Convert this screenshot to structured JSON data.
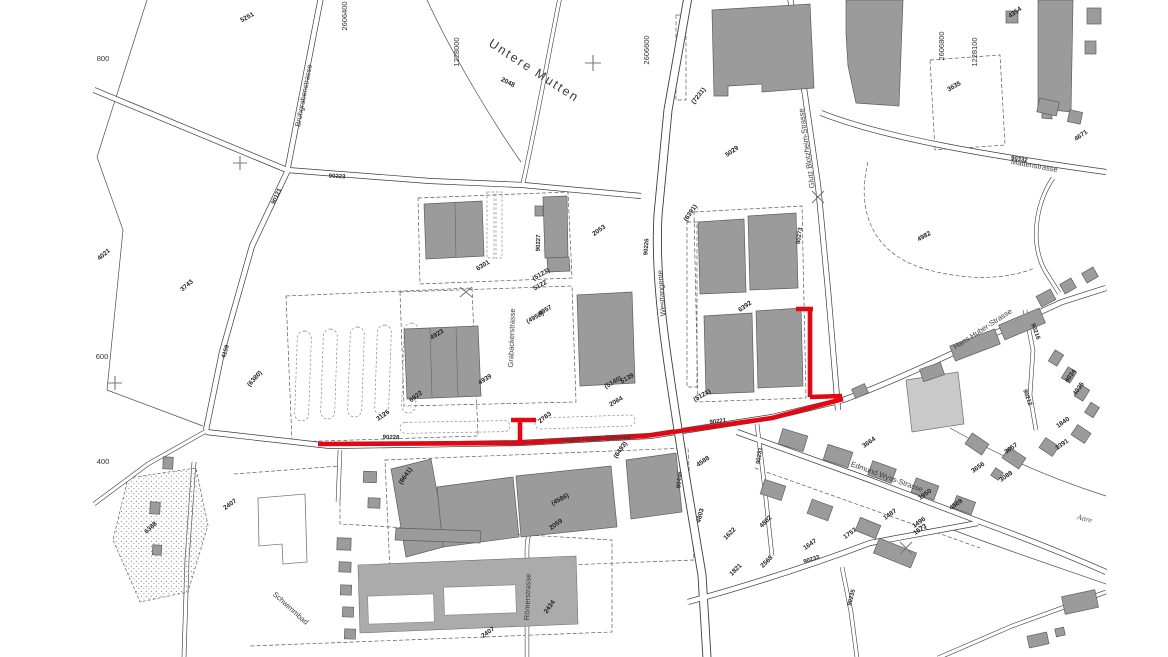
{
  "map": {
    "colors": {
      "route_highlight": "#e30613",
      "building_fill": "#9b9b9b",
      "building_light": "#c9c9c9",
      "line": "#3d3d3d"
    },
    "area_labels": [
      {
        "text": "Untere Mutten",
        "x": 532,
        "y": 74,
        "rot": 33
      }
    ],
    "street_labels": [
      {
        "text": "Brühgrabenstrasse",
        "x": 306,
        "y": 96,
        "rot": -79
      },
      {
        "text": "Glutz Blotzheim-Strasse",
        "x": 809,
        "y": 148,
        "rot": -98
      },
      {
        "text": "Grabackerstrasse",
        "x": 514,
        "y": 338,
        "rot": -88
      },
      {
        "text": "Westtangente",
        "x": 664,
        "y": 293,
        "rot": -94
      },
      {
        "text": "Mattenstrasse",
        "x": 1034,
        "y": 168,
        "rot": 10
      },
      {
        "text": "Hans Huber-Strasse",
        "x": 597,
        "y": 441,
        "rot": -3
      },
      {
        "text": "Hans Huber-Strasse",
        "x": 984,
        "y": 331,
        "rot": -33
      },
      {
        "text": "Edmund Wyss-Strasse",
        "x": 886,
        "y": 479,
        "rot": 20
      },
      {
        "text": "Römerstrasse",
        "x": 530,
        "y": 597,
        "rot": -88
      },
      {
        "text": "Schwimmbad",
        "x": 289,
        "y": 610,
        "rot": 42,
        "size": 6.5
      }
    ],
    "water_labels": [
      {
        "text": "Aare",
        "x": 1084,
        "y": 521,
        "rot": 15
      }
    ],
    "road_numbers": [
      {
        "text": "90223",
        "x": 337,
        "y": 178,
        "rot": 3
      },
      {
        "text": "90121",
        "x": 278,
        "y": 197,
        "rot": -66
      },
      {
        "text": "4159",
        "x": 227,
        "y": 352,
        "rot": -73
      },
      {
        "text": "90227",
        "x": 540,
        "y": 243,
        "rot": -88
      },
      {
        "text": "90226",
        "x": 648,
        "y": 247,
        "rot": -86
      },
      {
        "text": "90273",
        "x": 801,
        "y": 236,
        "rot": -83
      },
      {
        "text": "90228",
        "x": 391,
        "y": 439,
        "rot": 2
      },
      {
        "text": "90221",
        "x": 718,
        "y": 423,
        "rot": -7
      },
      {
        "text": "90231",
        "x": 761,
        "y": 456,
        "rot": -82
      },
      {
        "text": "90446",
        "x": 681,
        "y": 480,
        "rot": -86
      },
      {
        "text": "90233",
        "x": 812,
        "y": 561,
        "rot": -18
      },
      {
        "text": "90235",
        "x": 853,
        "y": 598,
        "rot": -75
      },
      {
        "text": "90332",
        "x": 1019,
        "y": 161,
        "rot": 10
      },
      {
        "text": "90216",
        "x": 1034,
        "y": 332,
        "rot": 70
      },
      {
        "text": "90212",
        "x": 1026,
        "y": 398,
        "rot": 70
      }
    ],
    "coordinate_labels": [
      {
        "text": "2606400",
        "x": 347,
        "y": 16,
        "rot": -90
      },
      {
        "text": "1228000",
        "x": 459,
        "y": 52,
        "rot": -90
      },
      {
        "text": "2606600",
        "x": 649,
        "y": 50,
        "rot": -90
      },
      {
        "text": "2606800",
        "x": 944,
        "y": 46,
        "rot": -90
      },
      {
        "text": "1228100",
        "x": 977,
        "y": 52,
        "rot": -90
      },
      {
        "text": "800",
        "x": 103,
        "y": 61,
        "rot": 0
      },
      {
        "text": "600",
        "x": 102,
        "y": 359,
        "rot": 0
      },
      {
        "text": "400",
        "x": 103,
        "y": 464,
        "rot": 0
      }
    ],
    "parcel_numbers": [
      {
        "text": "5251",
        "x": 248,
        "y": 19,
        "rot": -28
      },
      {
        "text": "4021",
        "x": 105,
        "y": 256,
        "rot": -40
      },
      {
        "text": "3743",
        "x": 188,
        "y": 287,
        "rot": -40
      },
      {
        "text": "2048",
        "x": 507,
        "y": 84,
        "rot": 27
      },
      {
        "text": "2053",
        "x": 600,
        "y": 232,
        "rot": -35
      },
      {
        "text": "5029",
        "x": 733,
        "y": 153,
        "rot": -35
      },
      {
        "text": "(7231)",
        "x": 700,
        "y": 97,
        "rot": -52
      },
      {
        "text": "3635",
        "x": 955,
        "y": 88,
        "rot": -30
      },
      {
        "text": "4354",
        "x": 1016,
        "y": 14,
        "rot": -35
      },
      {
        "text": "4671",
        "x": 1082,
        "y": 137,
        "rot": -35
      },
      {
        "text": "4982",
        "x": 925,
        "y": 238,
        "rot": -30
      },
      {
        "text": "6301",
        "x": 484,
        "y": 267,
        "rot": -32
      },
      {
        "text": "(5123)",
        "x": 542,
        "y": 276,
        "rot": -30
      },
      {
        "text": "5122",
        "x": 541,
        "y": 287,
        "rot": -30
      },
      {
        "text": "4957",
        "x": 546,
        "y": 312,
        "rot": -30
      },
      {
        "text": "(4958)",
        "x": 536,
        "y": 319,
        "rot": -30
      },
      {
        "text": "4923",
        "x": 438,
        "y": 336,
        "rot": -32
      },
      {
        "text": "4939",
        "x": 486,
        "y": 381,
        "rot": -32
      },
      {
        "text": "5139",
        "x": 628,
        "y": 380,
        "rot": -30
      },
      {
        "text": "(5140)",
        "x": 614,
        "y": 384,
        "rot": -30
      },
      {
        "text": "2064",
        "x": 617,
        "y": 403,
        "rot": -30
      },
      {
        "text": "(5121)",
        "x": 703,
        "y": 397,
        "rot": -30
      },
      {
        "text": "6392",
        "x": 746,
        "y": 308,
        "rot": -35
      },
      {
        "text": "(6391)",
        "x": 692,
        "y": 214,
        "rot": -55
      },
      {
        "text": "2783",
        "x": 546,
        "y": 419,
        "rot": -38
      },
      {
        "text": "6922",
        "x": 417,
        "y": 398,
        "rot": -38
      },
      {
        "text": "3125",
        "x": 384,
        "y": 417,
        "rot": -35
      },
      {
        "text": "(6380)",
        "x": 256,
        "y": 380,
        "rot": -48
      },
      {
        "text": "(6493)",
        "x": 622,
        "y": 451,
        "rot": -55
      },
      {
        "text": "(6641)",
        "x": 407,
        "y": 477,
        "rot": -55
      },
      {
        "text": "4588",
        "x": 704,
        "y": 463,
        "rot": -35
      },
      {
        "text": "(4586)",
        "x": 561,
        "y": 501,
        "rot": -28
      },
      {
        "text": "2059",
        "x": 557,
        "y": 526,
        "rot": -35
      },
      {
        "text": "2434",
        "x": 551,
        "y": 608,
        "rot": -55
      },
      {
        "text": "2407",
        "x": 489,
        "y": 634,
        "rot": -35
      },
      {
        "text": "2407",
        "x": 231,
        "y": 506,
        "rot": -35
      },
      {
        "text": "6388",
        "x": 152,
        "y": 529,
        "rot": -42
      },
      {
        "text": "3664",
        "x": 870,
        "y": 444,
        "rot": -35
      },
      {
        "text": "4803",
        "x": 702,
        "y": 516,
        "rot": -75
      },
      {
        "text": "4802",
        "x": 767,
        "y": 523,
        "rot": -45
      },
      {
        "text": "1622",
        "x": 731,
        "y": 535,
        "rot": -45
      },
      {
        "text": "2568",
        "x": 768,
        "y": 563,
        "rot": -45
      },
      {
        "text": "1821",
        "x": 737,
        "y": 571,
        "rot": -45
      },
      {
        "text": "1647",
        "x": 811,
        "y": 546,
        "rot": -35
      },
      {
        "text": "1757",
        "x": 851,
        "y": 535,
        "rot": -35
      },
      {
        "text": "1487",
        "x": 891,
        "y": 516,
        "rot": -35
      },
      {
        "text": "1950",
        "x": 926,
        "y": 496,
        "rot": -35
      },
      {
        "text": "1496",
        "x": 920,
        "y": 524,
        "rot": -35
      },
      {
        "text": "1573",
        "x": 921,
        "y": 531,
        "rot": -35
      },
      {
        "text": "4569",
        "x": 957,
        "y": 506,
        "rot": -35
      },
      {
        "text": "3656",
        "x": 979,
        "y": 469,
        "rot": -35
      },
      {
        "text": "3657",
        "x": 1012,
        "y": 450,
        "rot": -35
      },
      {
        "text": "3088",
        "x": 1007,
        "y": 478,
        "rot": -35
      },
      {
        "text": "1391",
        "x": 1063,
        "y": 446,
        "rot": -35
      },
      {
        "text": "1840",
        "x": 1064,
        "y": 424,
        "rot": -35
      },
      {
        "text": "4034",
        "x": 1072,
        "y": 377,
        "rot": -55
      },
      {
        "text": "4035",
        "x": 1080,
        "y": 390,
        "rot": -55
      }
    ]
  }
}
